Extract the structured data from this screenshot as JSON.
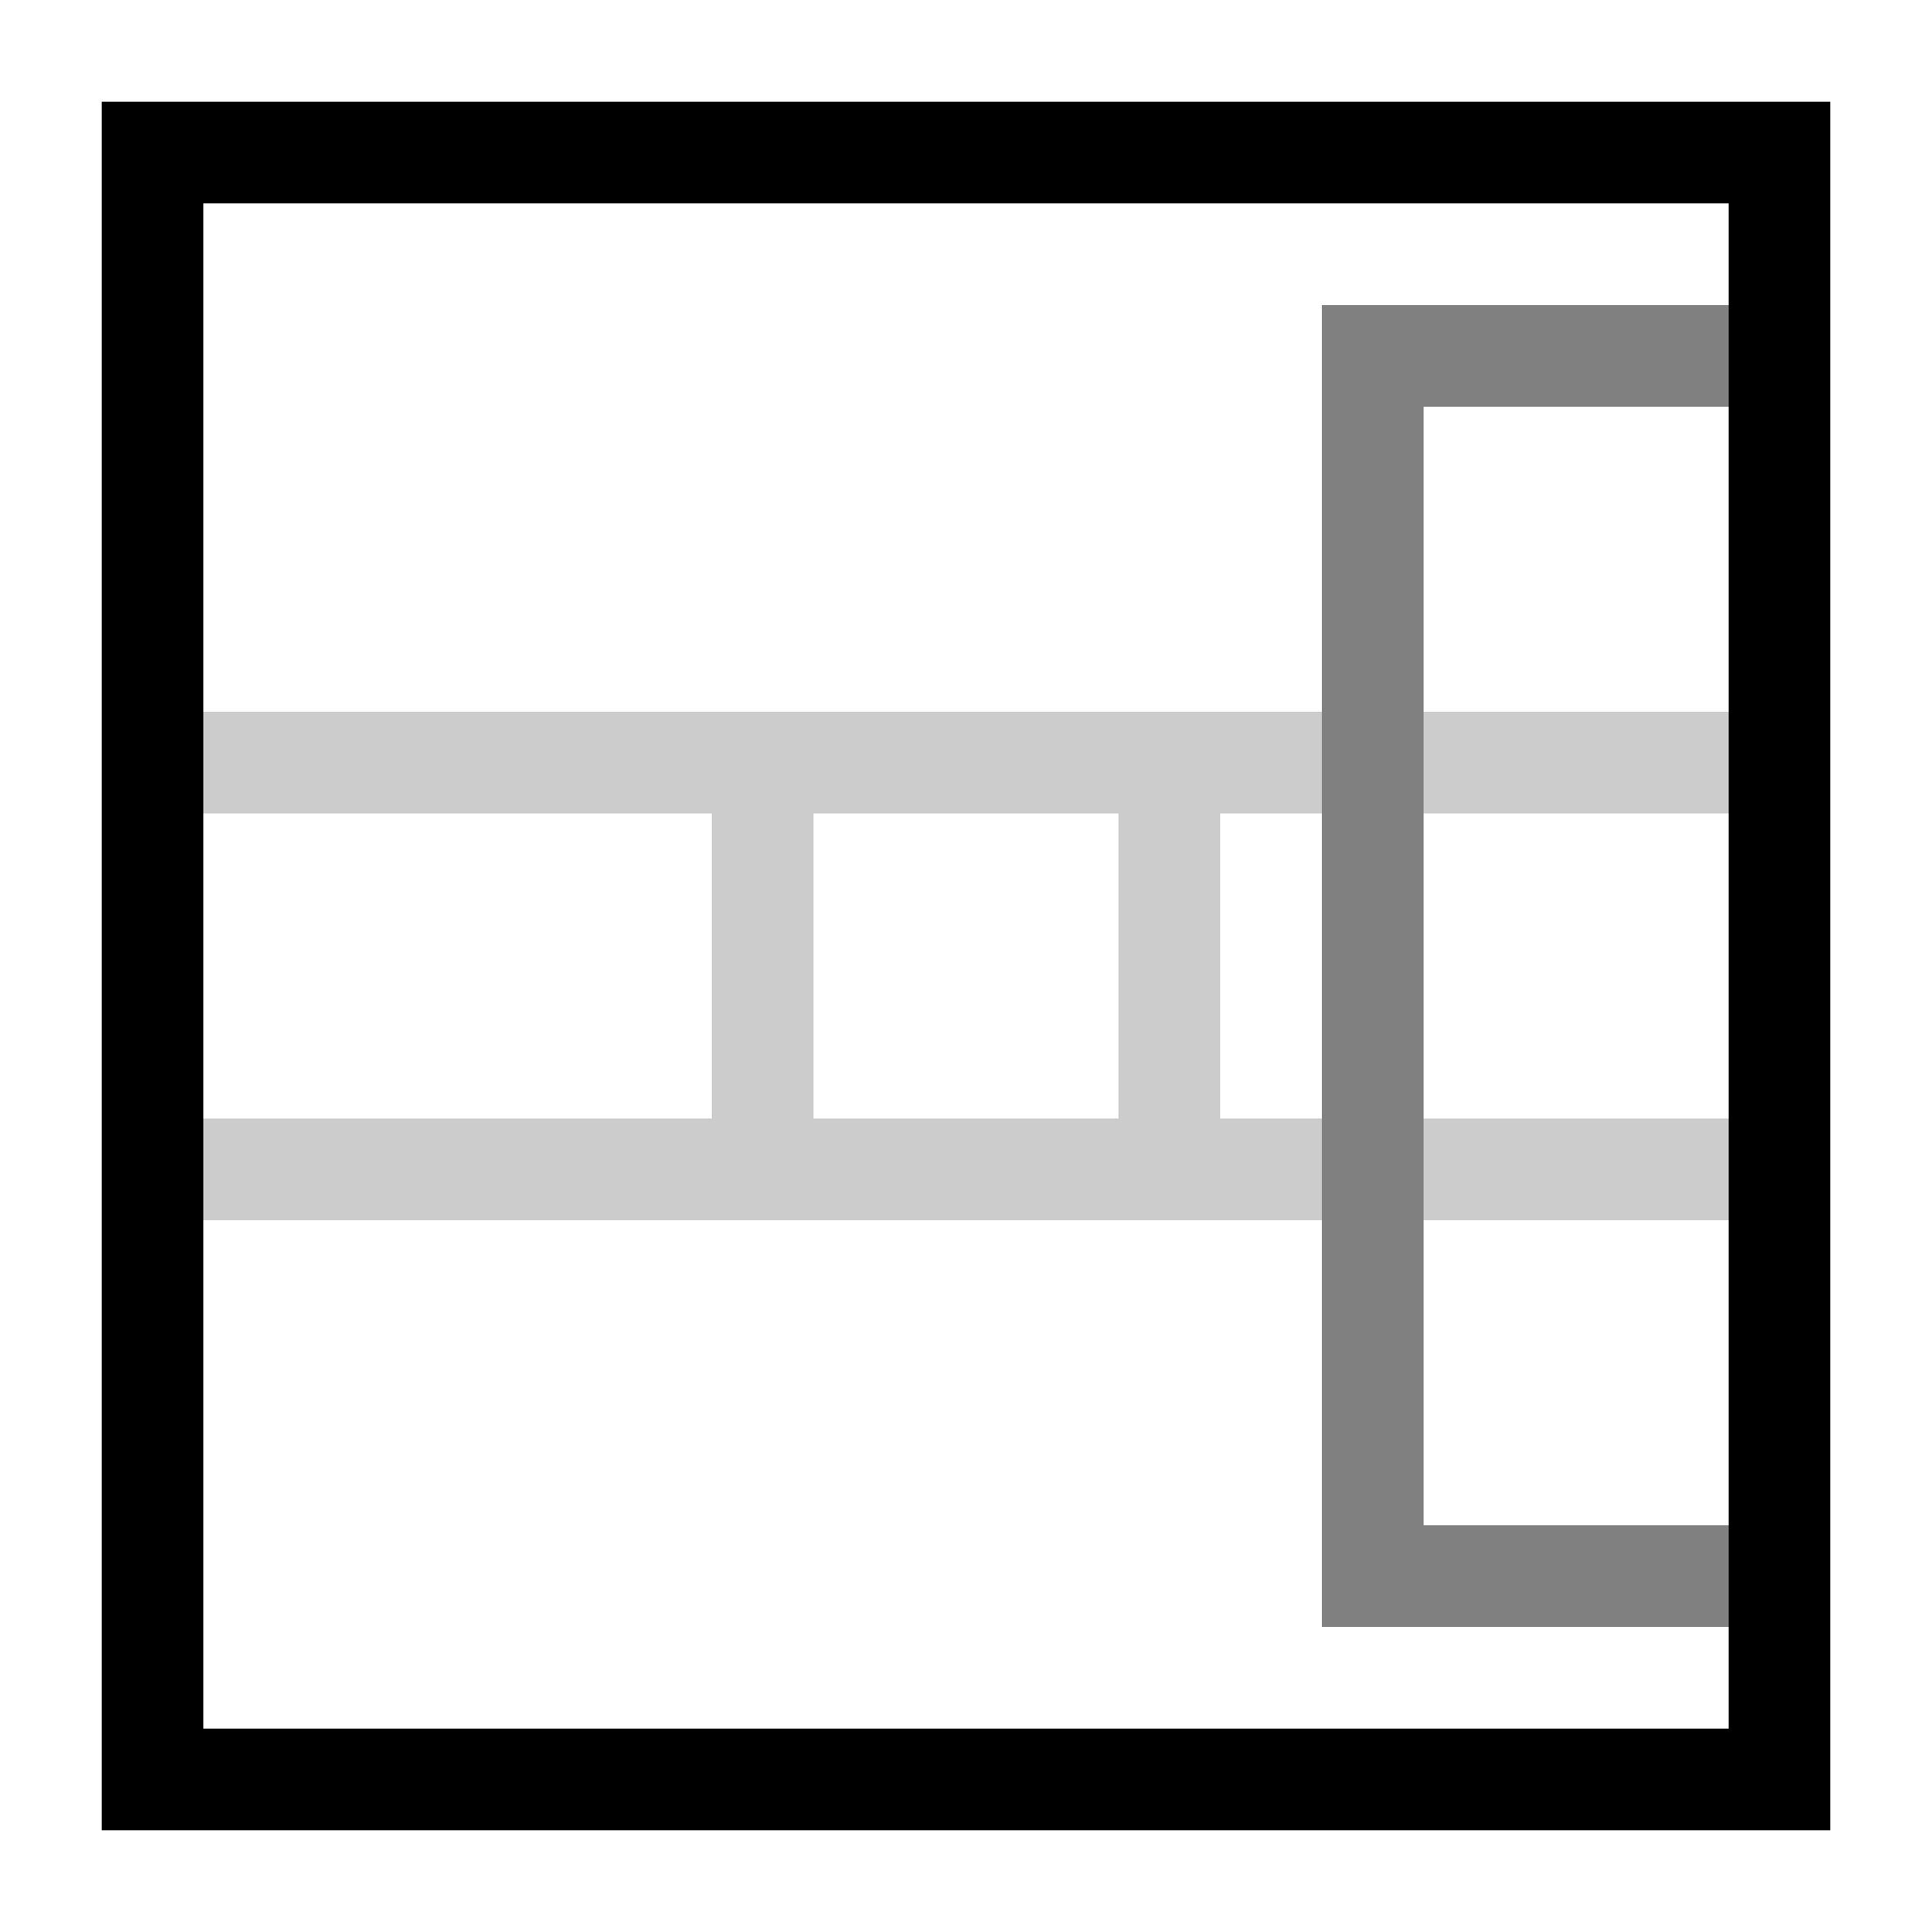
{
  "icon": {
    "name": "freeze-rows-and-columns-icon"
  },
  "colors": {
    "background": "#ffffff",
    "frame": "#000000",
    "gridline": "#cccccc",
    "highlight": "#808080"
  }
}
